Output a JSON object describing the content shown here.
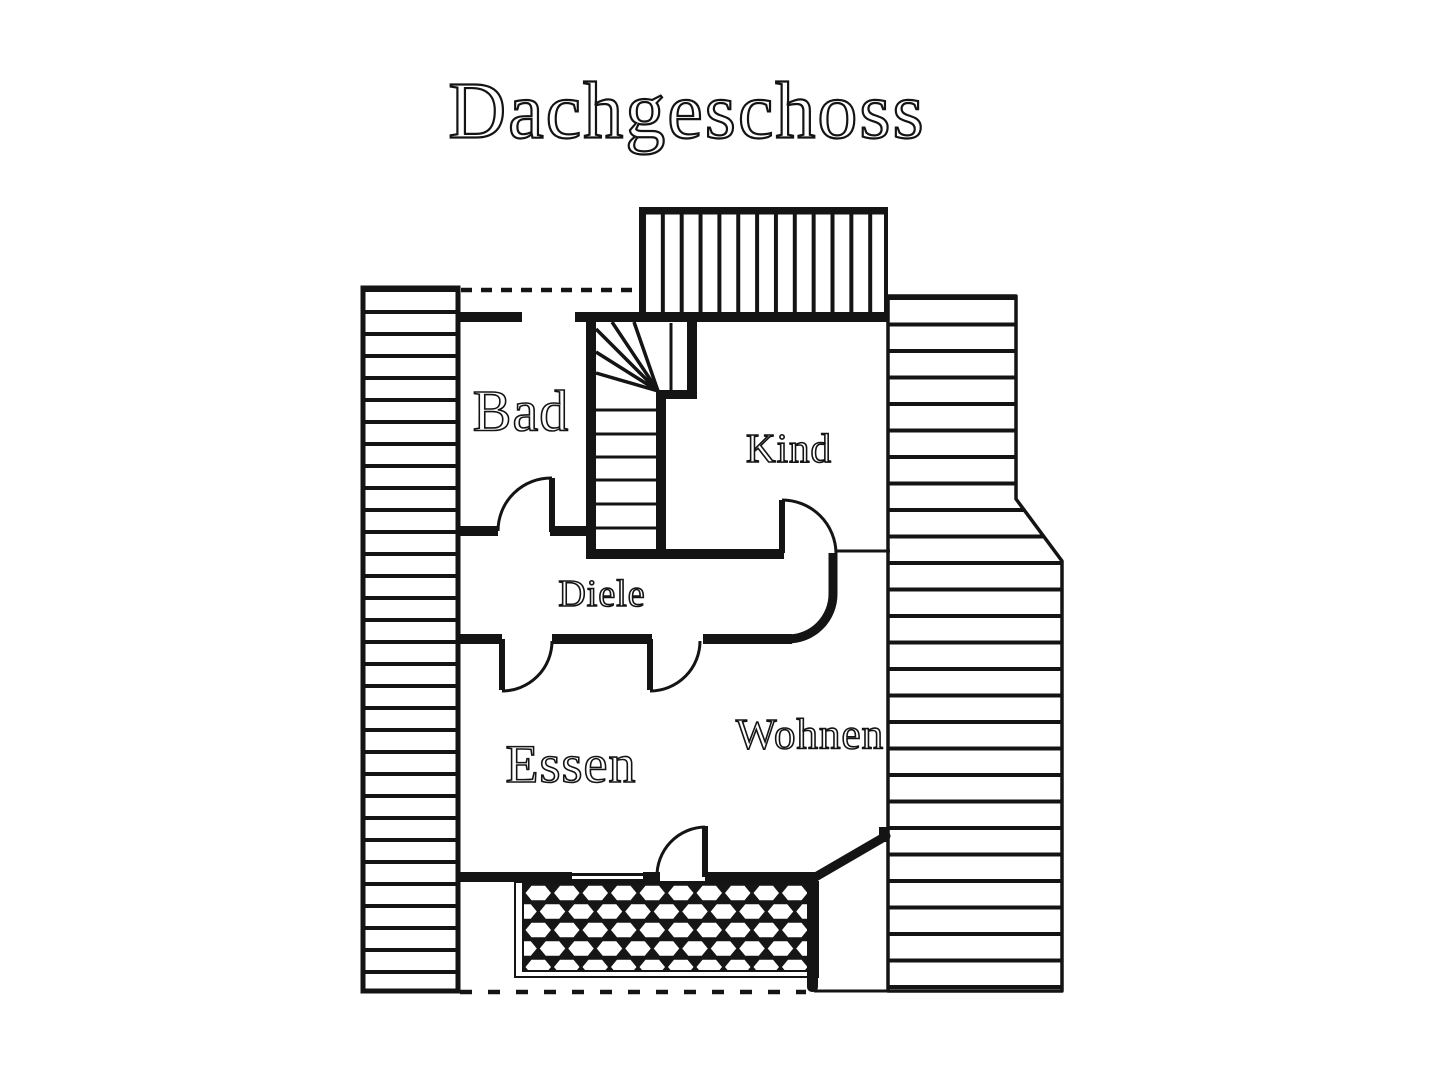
{
  "title": "Dachgeschoss",
  "rooms": {
    "bad": {
      "label": "Bad"
    },
    "kind": {
      "label": "Kind"
    },
    "diele": {
      "label": "Diele"
    },
    "essen": {
      "label": "Essen"
    },
    "wohnen": {
      "label": "Wohnen"
    }
  },
  "legend": {
    "plan_type": "floor-plan",
    "floor": "attic"
  },
  "colors": {
    "ink": "#141414",
    "background": "#ffffff",
    "terrace_fill": "#161616"
  }
}
